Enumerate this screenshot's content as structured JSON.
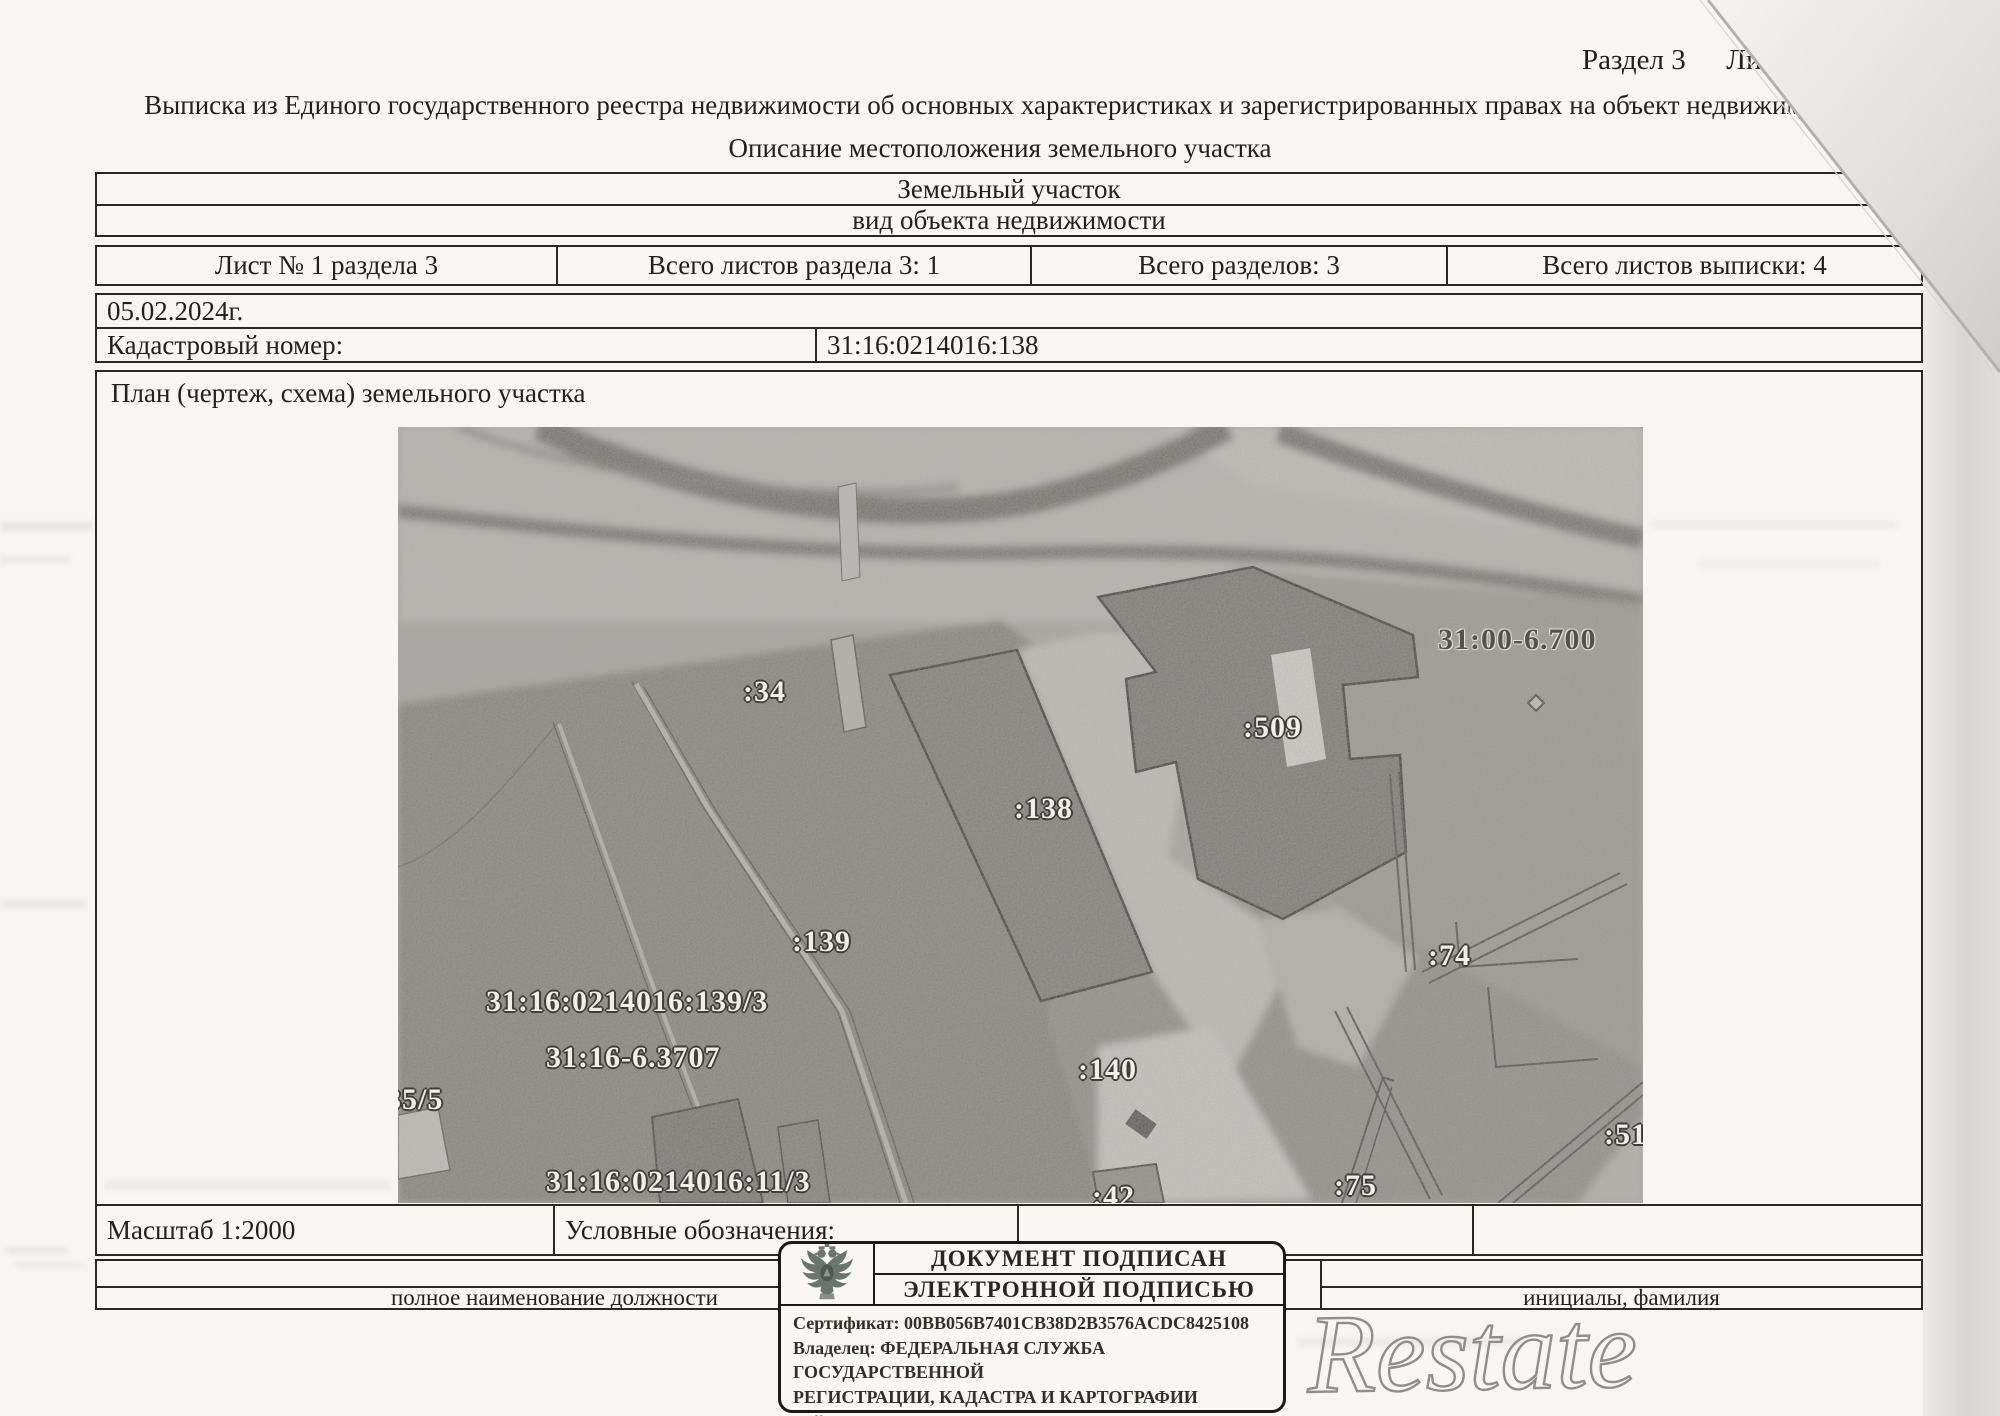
{
  "page": {
    "section_header": "Раздел 3",
    "section_header_cut": "Ли",
    "title": "Выписка из Единого государственного реестра недвижимости об основных характеристиках и зарегистрированных правах на объект недвижимости",
    "subtitle": "Описание местоположения земельного участка"
  },
  "object_table": {
    "object_type": "Земельный участок",
    "object_type_caption": "вид объекта недвижимости"
  },
  "sheet_row": {
    "sheet": "Лист № 1 раздела 3",
    "sheets_in_section": "Всего листов раздела 3: 1",
    "sections_total": "Всего разделов: 3",
    "sheets_total": "Всего листов выписки: 4"
  },
  "info_table": {
    "date": "05.02.2024г.",
    "cadastral_label": "Кадастровый номер:",
    "cadastral_number": "31:16:0214016:138"
  },
  "plan": {
    "caption": "План (чертеж, схема) земельного участка",
    "scale_label": "Масштаб 1:2000",
    "legend_label": "Условные обозначения:",
    "map_labels": {
      "parcel_34": ":34",
      "parcel_509": ":509",
      "zone_31_00_6_700": "31:00-6.700",
      "parcel_138": ":138",
      "parcel_139": ":139",
      "boundary_139_3": "31:16:0214016:139/3",
      "zone_31_16_6_3707": "31:16-6.3707",
      "parcel_35_5": "35/5",
      "boundary_11_3": "31:16:0214016:11/3",
      "parcel_140": ":140",
      "parcel_42": ":42",
      "parcel_75": ":75",
      "parcel_74": ":74",
      "parcel_51": ":51"
    }
  },
  "signature_block": {
    "position_caption": "полное наименование должности",
    "name_caption": "инициалы, фамилия"
  },
  "stamp": {
    "title_line1": "ДОКУМЕНТ ПОДПИСАН",
    "title_line2": "ЭЛЕКТРОННОЙ ПОДПИСЬЮ",
    "certificate": "Сертификат: 00BB056B7401CB38D2B3576ACDC8425108",
    "owner_line1": "Владелец: ФЕДЕРАЛЬНАЯ СЛУЖБА ГОСУДАРСТВЕННОЙ",
    "owner_line2": "РЕГИСТРАЦИИ, КАДАСТРА И КАРТОГРАФИИ",
    "validity": "Действителен: с 27.06.2023 по 19.09.2024"
  },
  "watermark": {
    "text": "Restate"
  }
}
